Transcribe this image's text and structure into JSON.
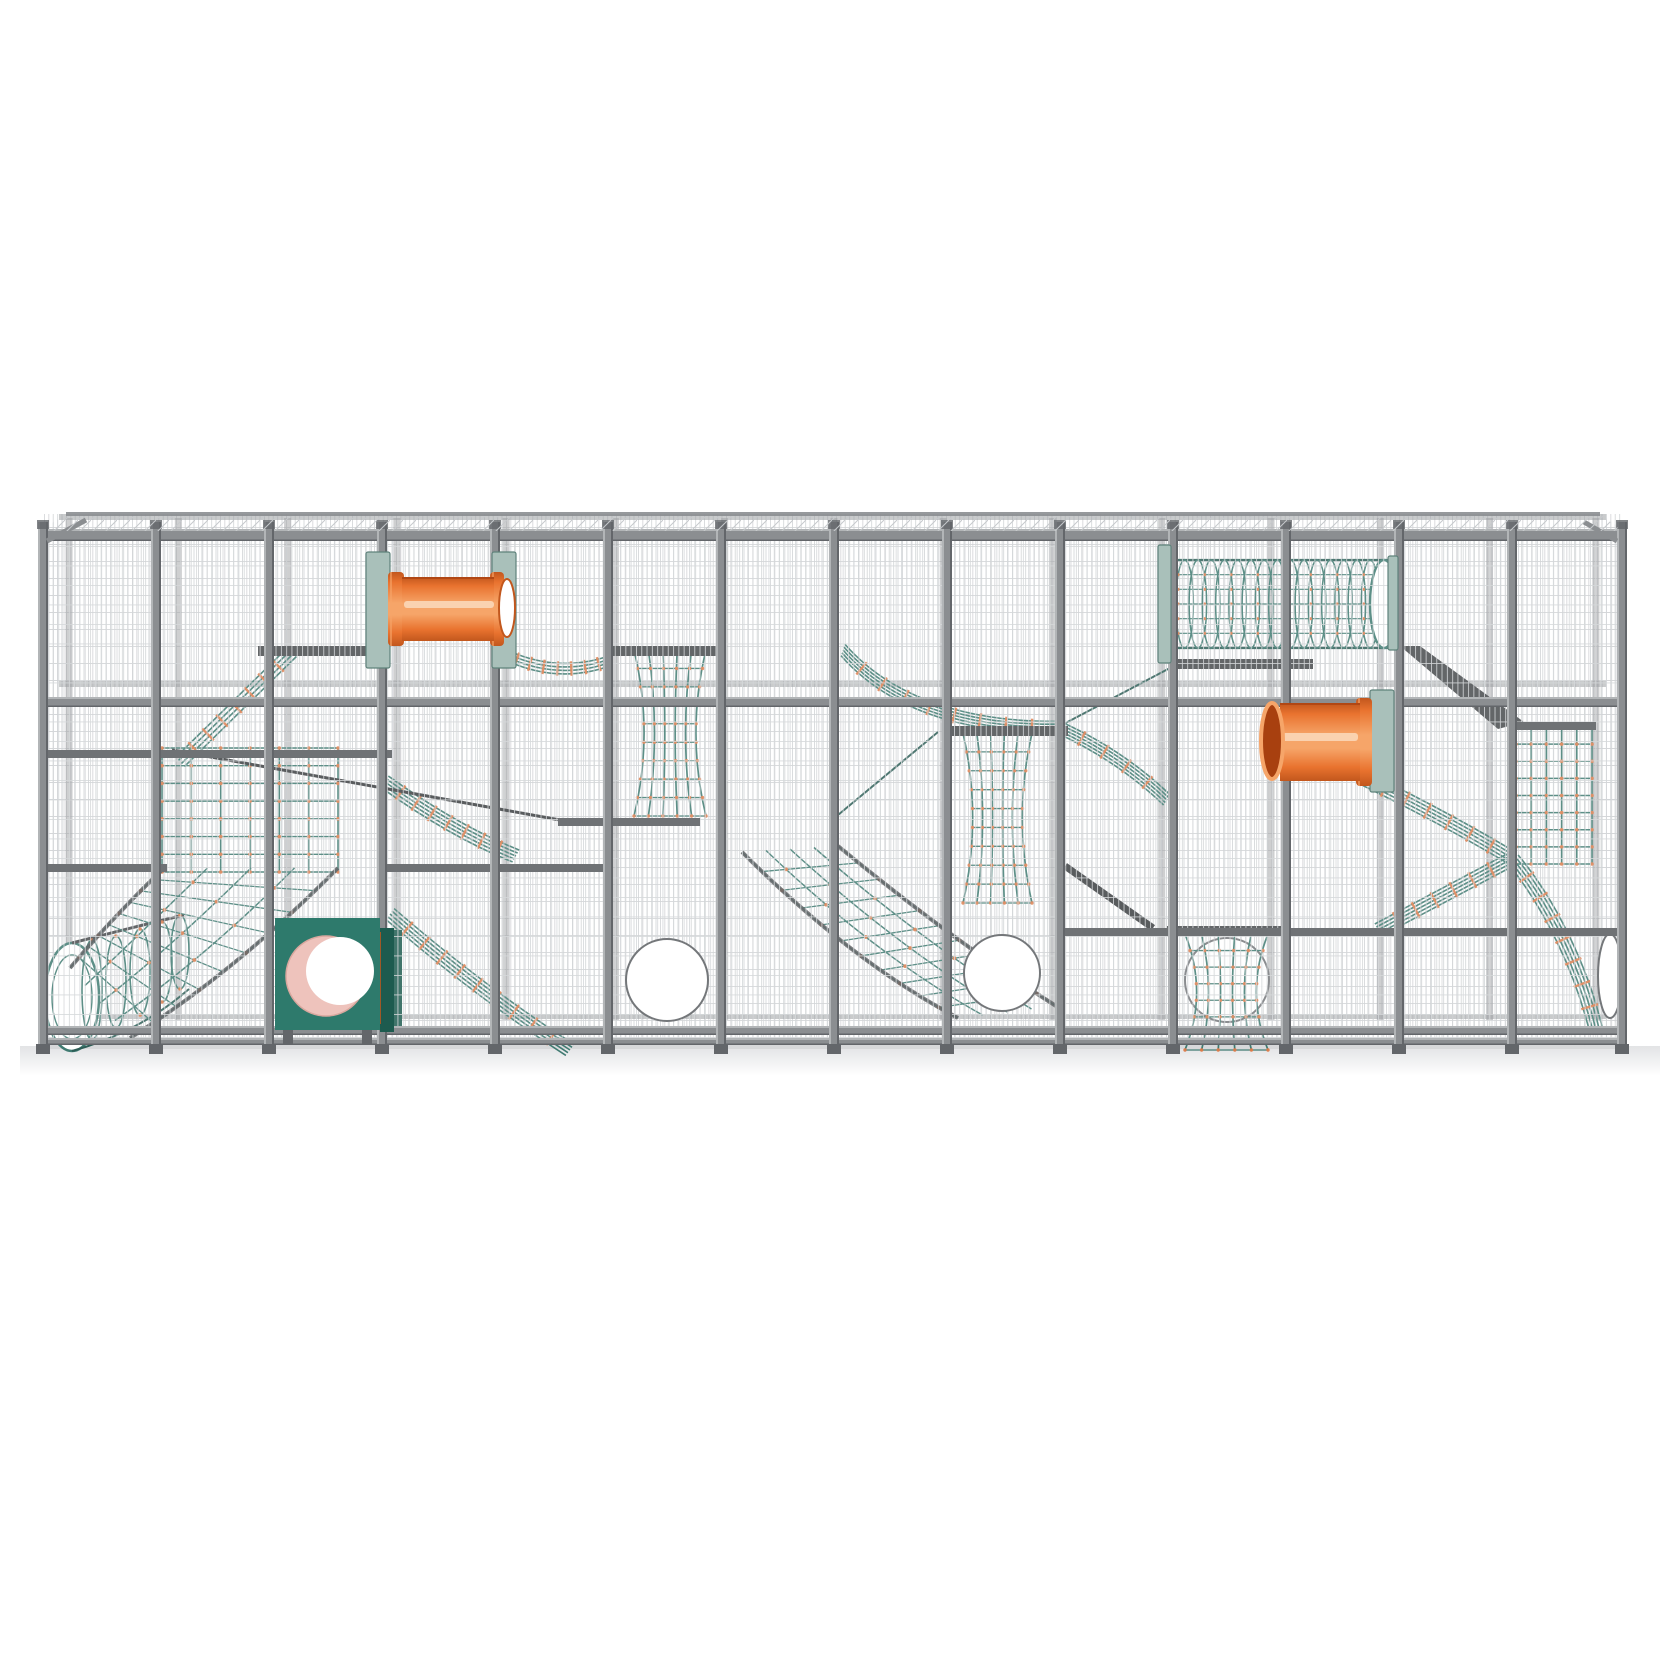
{
  "colors": {
    "bg": "#ffffff",
    "mesh": "#c6c9cc",
    "mesh-front": "#d5d8da",
    "frame": "#8b8e91",
    "frame-light": "#b2b5b7",
    "frame-dark": "#63666a",
    "beam": "#46494c",
    "beam-thin": "#3a3d40",
    "rail-partial": "#6f7275",
    "rope": "#3f7a71",
    "rope-dark": "#2d5d56",
    "clamp": "#dd7a48",
    "tube": "#e9732f",
    "tube-light": "#f6a569",
    "tube-dark": "#c2571d",
    "tube-rim": "#a8400f",
    "tube-highlight": "#fbd7b8",
    "sage": "#a9c0ba",
    "sage-edge": "#5f827b",
    "teal": "#2e7a6c",
    "teal-dark": "#1d5b4f",
    "pink": "#eec3bc",
    "pink-dark": "#d9a79e",
    "ground": "#e2e3e5",
    "circle-stroke": "#74777a",
    "white": "#ffffff"
  },
  "frame": {
    "left": 43,
    "right": 1622,
    "roof_back_y": 514,
    "top_rail_y": 529,
    "mid_rail_y": 697,
    "bottom_rail_y": 1026,
    "bottom_rail2_y": 1038,
    "post_top": 522,
    "post_bottom": 1045,
    "post_w": 10,
    "ground_y": 1048,
    "post_xs": [
      43,
      156,
      269,
      382,
      495,
      608,
      721,
      834,
      947,
      1060,
      1173,
      1286,
      1399,
      1512,
      1622
    ],
    "rails_full": [
      {
        "y": 529,
        "h": 12
      },
      {
        "y": 697,
        "h": 10
      },
      {
        "y": 1026,
        "h": 9
      },
      {
        "y": 1038,
        "h": 7
      }
    ],
    "rails_back": [
      {
        "y": 514,
        "h": 6
      },
      {
        "y": 681,
        "h": 6
      },
      {
        "y": 1014,
        "h": 5
      }
    ],
    "rails_partial": [
      {
        "x1": 43,
        "x2": 392,
        "y": 750
      },
      {
        "x1": 43,
        "x2": 167,
        "y": 864
      },
      {
        "x1": 380,
        "x2": 612,
        "y": 864
      },
      {
        "x1": 558,
        "x2": 700,
        "y": 818
      },
      {
        "x1": 1056,
        "x2": 1622,
        "y": 928
      },
      {
        "x1": 1512,
        "x2": 1596,
        "y": 722
      }
    ],
    "shelves": [
      {
        "x1": 258,
        "x2": 366,
        "y": 646
      },
      {
        "x1": 608,
        "x2": 722,
        "y": 646
      },
      {
        "x1": 947,
        "x2": 1068,
        "y": 726
      },
      {
        "x1": 1167,
        "x2": 1287,
        "y": 926
      },
      {
        "x1": 1178,
        "x2": 1313,
        "y": 659
      }
    ],
    "diag_beams": [
      {
        "x1": 1065,
        "y1": 866,
        "x2": 1153,
        "y2": 928,
        "w": 7
      },
      {
        "x1": 172,
        "y1": 750,
        "x2": 560,
        "y2": 820,
        "w": 3
      }
    ],
    "braces": [
      {
        "x1": 47,
        "y1": 541,
        "x2": 86,
        "y2": 520,
        "w": 5
      },
      {
        "x1": 1617,
        "y1": 541,
        "x2": 1584,
        "y2": 522,
        "w": 5
      }
    ],
    "slide_pts": "1400,646 1420,646 1524,722 1498,729"
  },
  "tubes": [
    {
      "body": [
        402,
        577,
        92,
        64
      ],
      "flanges": [
        [
          388,
          572,
          16,
          74
        ],
        [
          490,
          572,
          14,
          74
        ]
      ],
      "open": [
        {
          "cx": 507,
          "cy": 608,
          "rx": 8,
          "ry": 29,
          "style": "light"
        }
      ],
      "highlight": [
        404,
        601,
        90,
        7
      ]
    },
    {
      "body": [
        1280,
        703,
        80,
        78
      ],
      "flanges": [
        [
          1356,
          698,
          16,
          88
        ]
      ],
      "open": [
        {
          "cx": 1272,
          "cy": 741,
          "rx": 11,
          "ry": 38,
          "style": "dark"
        }
      ],
      "highlight": [
        1282,
        733,
        76,
        8
      ]
    }
  ],
  "plates": [
    {
      "x": 366,
      "y": 552,
      "w": 24,
      "h": 116
    },
    {
      "x": 492,
      "y": 552,
      "w": 24,
      "h": 116
    },
    {
      "x": 1370,
      "y": 690,
      "w": 24,
      "h": 102
    },
    {
      "x": 1158,
      "y": 545,
      "w": 13,
      "h": 118
    },
    {
      "x": 1388,
      "y": 556,
      "w": 10,
      "h": 94
    }
  ],
  "teal_bars": [
    {
      "x": 390,
      "y": 930,
      "w": 12,
      "h": 98
    }
  ],
  "teal_box": {
    "x": 275,
    "y": 918,
    "w": 105,
    "h": 112,
    "side_x": 380,
    "side_w": 14,
    "hole": {
      "cx": 326,
      "cy": 976,
      "r": 40
    },
    "hole_white": {
      "cx": 340,
      "cy": 971,
      "r": 34
    }
  },
  "portholes": [
    {
      "cx": 667,
      "cy": 980,
      "rx": 41,
      "ry": 41
    },
    {
      "cx": 1002,
      "cy": 973,
      "rx": 38,
      "ry": 38
    },
    {
      "cx": 1610,
      "cy": 976,
      "rx": 12,
      "ry": 42
    }
  ],
  "flat_nets": [
    {
      "x": 162,
      "y": 748,
      "w": 176,
      "h": 124,
      "cols": 6,
      "rows": 7
    },
    {
      "x": 1516,
      "y": 727,
      "w": 76,
      "h": 137,
      "cols": 5,
      "rows": 8
    }
  ],
  "tower_nets": [
    {
      "x": 634,
      "y": 650,
      "w": 72,
      "h": 166,
      "rows": 9
    },
    {
      "x": 963,
      "y": 733,
      "w": 69,
      "h": 170,
      "rows": 9
    },
    {
      "x": 1185,
      "y": 934,
      "w": 83,
      "h": 116,
      "rows": 7,
      "circle": {
        "cx": 1227,
        "cy": 980,
        "r": 42
      }
    }
  ],
  "tunnel_net": {
    "x": 1178,
    "y": 560,
    "w": 212,
    "h": 88,
    "rings": 16,
    "lines": 5,
    "end": {
      "cx": 1384,
      "cy": 604,
      "rx": 14,
      "ry": 44
    }
  },
  "arch_tube": {
    "open": {
      "cx": 72,
      "cy": 997,
      "rx": 27,
      "ry": 54
    },
    "ribs": [
      [
        92,
        990,
        10,
        50
      ],
      [
        116,
        982,
        10,
        46
      ],
      [
        140,
        972,
        10,
        43
      ],
      [
        162,
        962,
        10,
        40
      ],
      [
        180,
        952,
        9,
        37
      ]
    ]
  },
  "ramp_nets": [
    {
      "e1": [
        338,
        868,
        235,
        972,
        130,
        1038
      ],
      "e2": [
        164,
        868,
        110,
        920,
        70,
        968
      ],
      "lines": 5,
      "cross": 8
    },
    {
      "e1": [
        742,
        852,
        852,
        962,
        958,
        1018
      ],
      "e2": [
        838,
        846,
        952,
        940,
        1056,
        1006
      ],
      "lines": 5,
      "cross": 10
    }
  ],
  "rope_bands": [
    {
      "d": "M180,762 L292,652",
      "p1": [
        180,
        762
      ],
      "p2": [
        292,
        652
      ],
      "n": 4,
      "gap": 4.2,
      "rungs": 7
    },
    {
      "d": "M504,654 Q558,680 612,660",
      "p1": [
        504,
        654
      ],
      "p2": [
        612,
        660
      ],
      "n": 4,
      "gap": 3.5,
      "rungs": 7
    },
    {
      "d": "M385,782 Q455,832 516,856",
      "p1": [
        385,
        782
      ],
      "p2": [
        516,
        856
      ],
      "n": 5,
      "gap": 3.4,
      "rungs": 7
    },
    {
      "d": "M390,914 Q480,992 570,1050",
      "p1": [
        390,
        914
      ],
      "p2": [
        570,
        1050
      ],
      "n": 5,
      "gap": 3.4,
      "rungs": 9
    },
    {
      "d": "M843,650 C900,715 990,728 1058,727",
      "p1": [
        843,
        650
      ],
      "p2": [
        1058,
        727
      ],
      "n": 5,
      "gap": 3,
      "rungs": 8
    },
    {
      "d": "M1058,727 Q1120,755 1167,800",
      "p1": [
        1058,
        727
      ],
      "p2": [
        1167,
        800
      ],
      "n": 5,
      "gap": 3,
      "rungs": 4
    },
    {
      "d": "M1363,778 Q1445,818 1512,858",
      "p1": [
        1363,
        778
      ],
      "p2": [
        1512,
        858
      ],
      "n": 5,
      "gap": 3.4,
      "rungs": 6
    },
    {
      "d": "M1512,858 C1552,906 1582,972 1596,1030",
      "p1": [
        1512,
        858
      ],
      "p2": [
        1596,
        1030
      ],
      "n": 5,
      "gap": 3.4,
      "rungs": 7
    },
    {
      "d": "M1378,930 Q1450,892 1510,860",
      "p1": [
        1378,
        930
      ],
      "p2": [
        1510,
        860
      ],
      "n": 5,
      "gap": 3.4,
      "rungs": 6
    }
  ],
  "thin_ropes": [
    {
      "x1": 1170,
      "y1": 668,
      "x2": 1058,
      "y2": 727
    },
    {
      "x1": 938,
      "y1": 732,
      "x2": 838,
      "y2": 815
    }
  ]
}
